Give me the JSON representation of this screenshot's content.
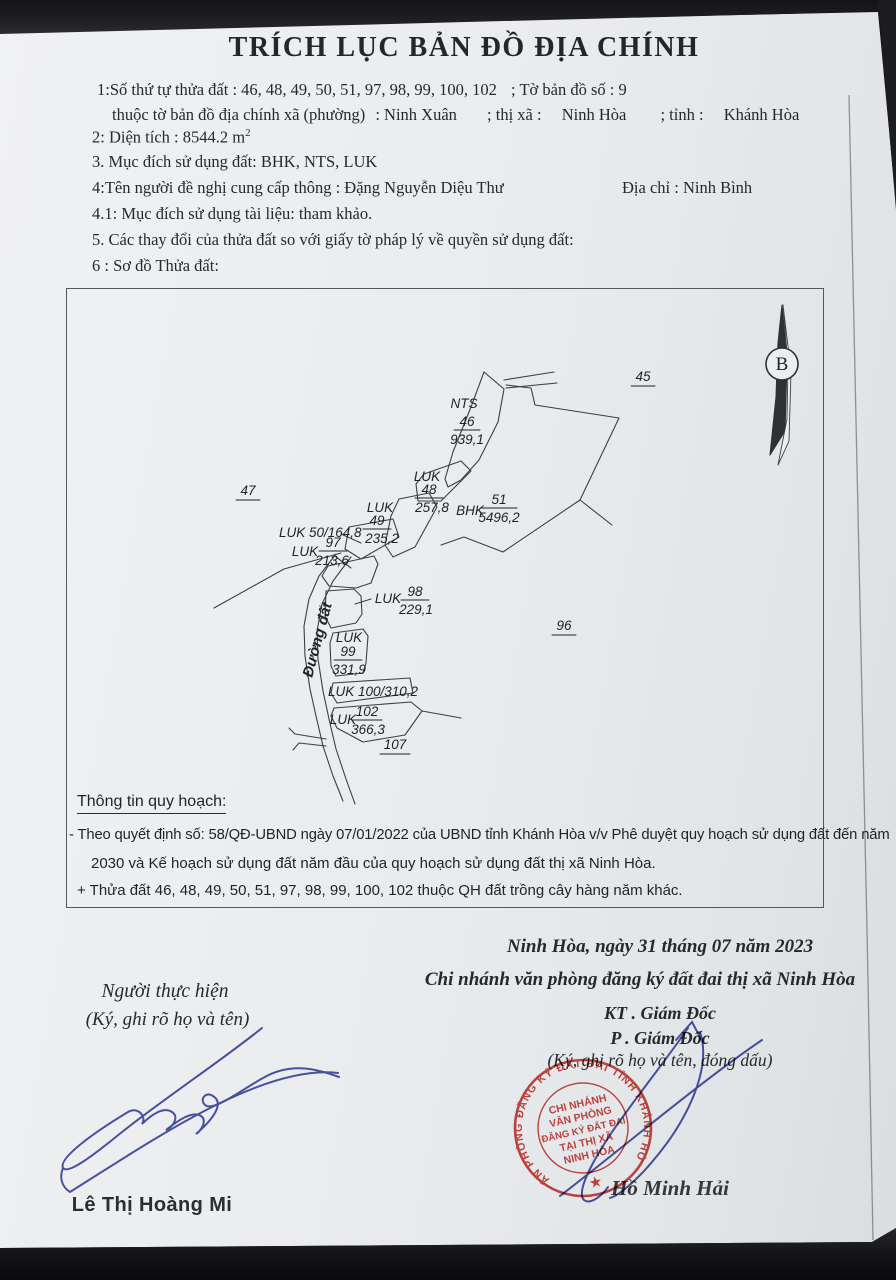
{
  "document": {
    "title": "TRÍCH LỤC BẢN ĐỒ ĐỊA CHÍNH",
    "fields": {
      "line1_left": "1:Số thứ tự thửa đất : 46, 48, 49, 50, 51, 97, 98, 99, 100, 102",
      "line1_right": "; Tờ bản đồ số : 9",
      "line2_label": "thuộc tờ bản đồ địa chính xã (phường)",
      "line2_commune": ": Ninh Xuân",
      "line2_town_label": "; thị xã :",
      "line2_town": "Ninh Hòa",
      "line2_province_label": "; tỉnh :",
      "line2_province": "Khánh Hòa",
      "area_line": "2: Diện tích : 8544.2 m",
      "area_sup": "2",
      "purpose_line": "3. Mục đích sử dụng đất: BHK, NTS, LUK",
      "requester_line": "4:Tên người đề nghị cung cấp thông : Đặng Nguyễn Diệu Thư",
      "address_line": "Địa chỉ  : Ninh Bình",
      "doc_purpose_line": "4.1: Mục đích sử dụng tài liệu: tham khảo.",
      "changes_line": "5. Các thay đổi của thửa đất so với giấy tờ pháp lý về quyền sử dụng đất:",
      "sketch_line": "6 : Sơ đồ Thửa đất:"
    }
  },
  "map": {
    "north_label": "B",
    "road_label": "Đường đất",
    "adjacent": {
      "p45": "45",
      "p47": "47",
      "p96": "96",
      "p107": "107"
    },
    "parcels": [
      {
        "code": "NTS",
        "num": "46",
        "area": "939,1"
      },
      {
        "code": "LUK",
        "num": "48",
        "area": "257,8"
      },
      {
        "code": "LUK",
        "num": "49",
        "area": "235,2"
      },
      {
        "code": "LUK",
        "num": "50",
        "area": "164,8",
        "label": "LUK 50/164,8"
      },
      {
        "code": "LUK",
        "num": "97",
        "area": "213,6"
      },
      {
        "code": "BHK",
        "num": "51",
        "area": "5496,2"
      },
      {
        "code": "LUK",
        "num": "98",
        "area": "229,1"
      },
      {
        "code": "LUK",
        "num": "99",
        "area": "331,9"
      },
      {
        "code": "LUK",
        "num": "100",
        "area": "310,2",
        "label": "LUK 100/310,2"
      },
      {
        "code": "LUK",
        "num": "102",
        "area": "366,3"
      }
    ]
  },
  "planning": {
    "heading": "Thông tin quy hoạch:",
    "line1": "- Theo quyết định số: 58/QĐ-UBND ngày 07/01/2022 của UBND tỉnh Khánh Hòa v/v Phê duyệt quy hoạch sử dụng đất đến năm",
    "line2": "2030 và Kế hoạch sử dụng đất năm đầu của quy hoạch sử dụng đất thị xã Ninh Hòa.",
    "line3": "+  Thửa đất 46, 48, 49, 50, 51, 97, 98, 99, 100, 102 thuộc QH đất trồng cây hàng năm khác."
  },
  "signatures": {
    "date_line": "Ninh Hòa, ngày 31 tháng  07  năm 2023",
    "org_line": "Chi nhánh văn phòng đăng ký đất đai thị xã Ninh Hòa",
    "kt_line": "KT . Giám Đốc",
    "deputy_line": "P . Giám Đốc",
    "right_note": "(Ký, ghi rõ họ và tên, đóng dấu)",
    "left_title": "Người thực hiện",
    "left_note": "(Ký, ghi rõ họ và tên)",
    "left_name": "Lê Thị Hoàng Mi",
    "right_name": "Hồ Minh Hải"
  },
  "stamp": {
    "ring_text": "VĂN PHÒNG ĐĂNG KÝ ĐẤT ĐAI TỈNH KHÁNH HÒA",
    "center_lines": [
      "CHI NHÁNH",
      "VĂN PHÒNG",
      "ĐĂNG KÝ ĐẤT ĐAI",
      "TẠI THỊ XÃ",
      "NINH HÒA"
    ],
    "star": "★",
    "color": "#c9352f"
  },
  "colors": {
    "paper": "#eceef0",
    "ink": "#26292c",
    "map_line": "#3c4043",
    "signature_blue": "#34409b",
    "stamp_red": "#c9352f"
  }
}
